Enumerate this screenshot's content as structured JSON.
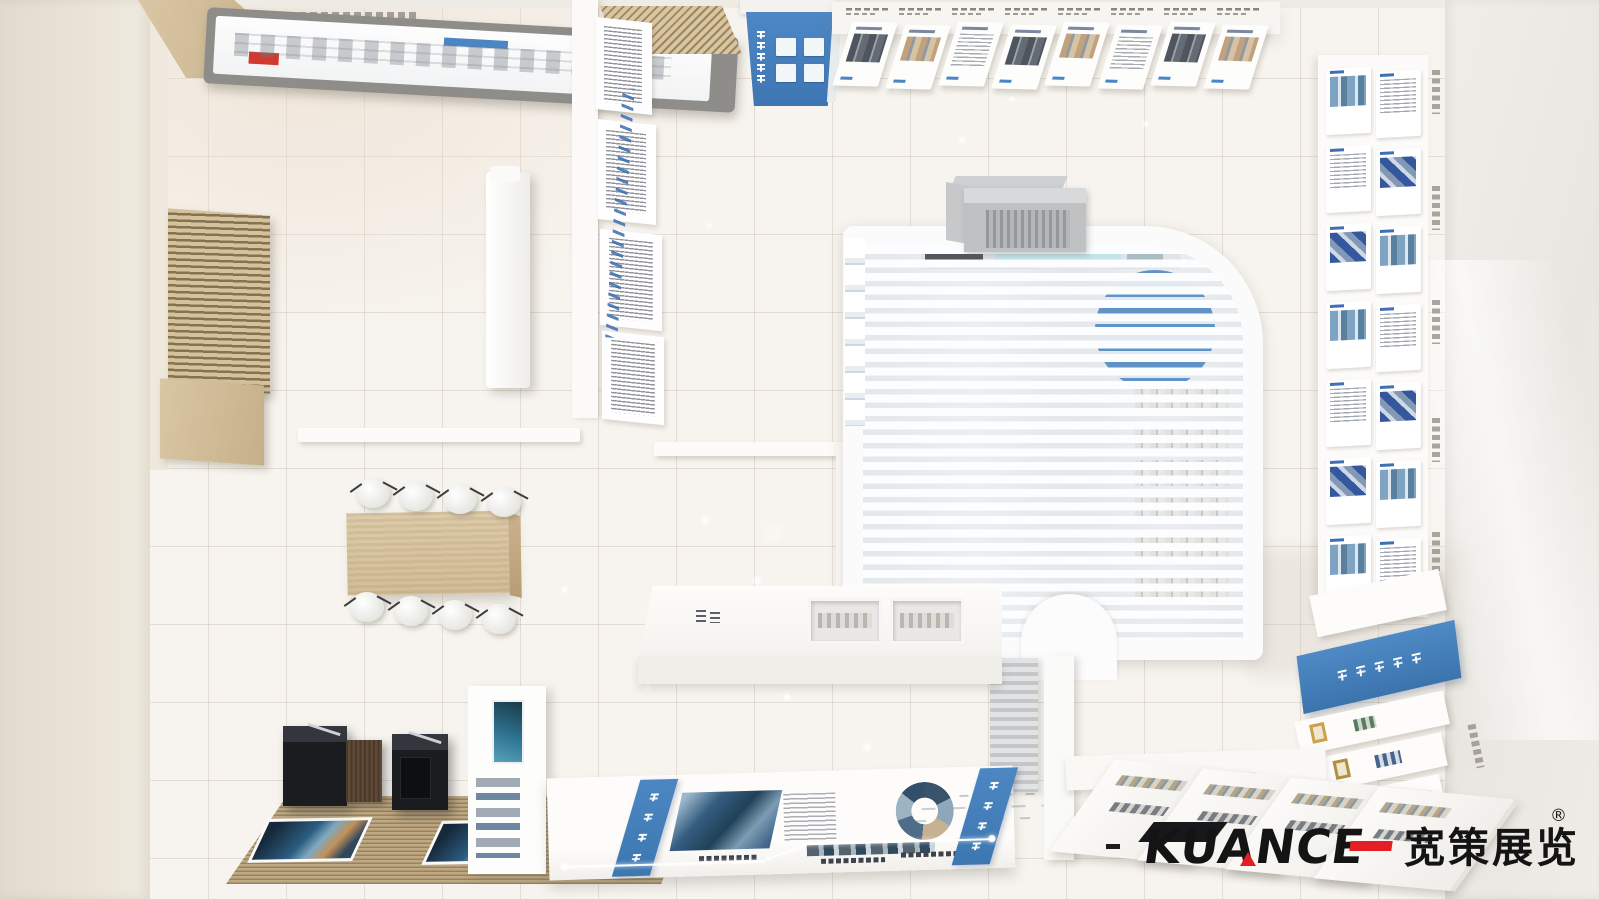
{
  "image": {
    "kind": "3d-rendered top-down (bird's-eye) view of an exhibition hall / showroom interior design",
    "width": 1599,
    "height": 899
  },
  "brand": {
    "dash": "—",
    "name": "KUANCE",
    "cn_name": "宽策展览",
    "registered": "®"
  },
  "palette": {
    "accent_blue": "#3f7fc1",
    "logo_red": "#e41e25",
    "logo_black": "#141414",
    "wood_light": "#d5c19c",
    "floor_tile": "#f7f4ef",
    "kiosk_black": "#1a1c20"
  },
  "counts": {
    "top_posters": 8,
    "right_wall_rows": 7,
    "chairs": 8,
    "kiosks": 2,
    "bottom_tables": 4,
    "room_shelf_rows": 6,
    "blue_sign_chars": 5,
    "banner_chars": 5,
    "band_chars": 4
  }
}
